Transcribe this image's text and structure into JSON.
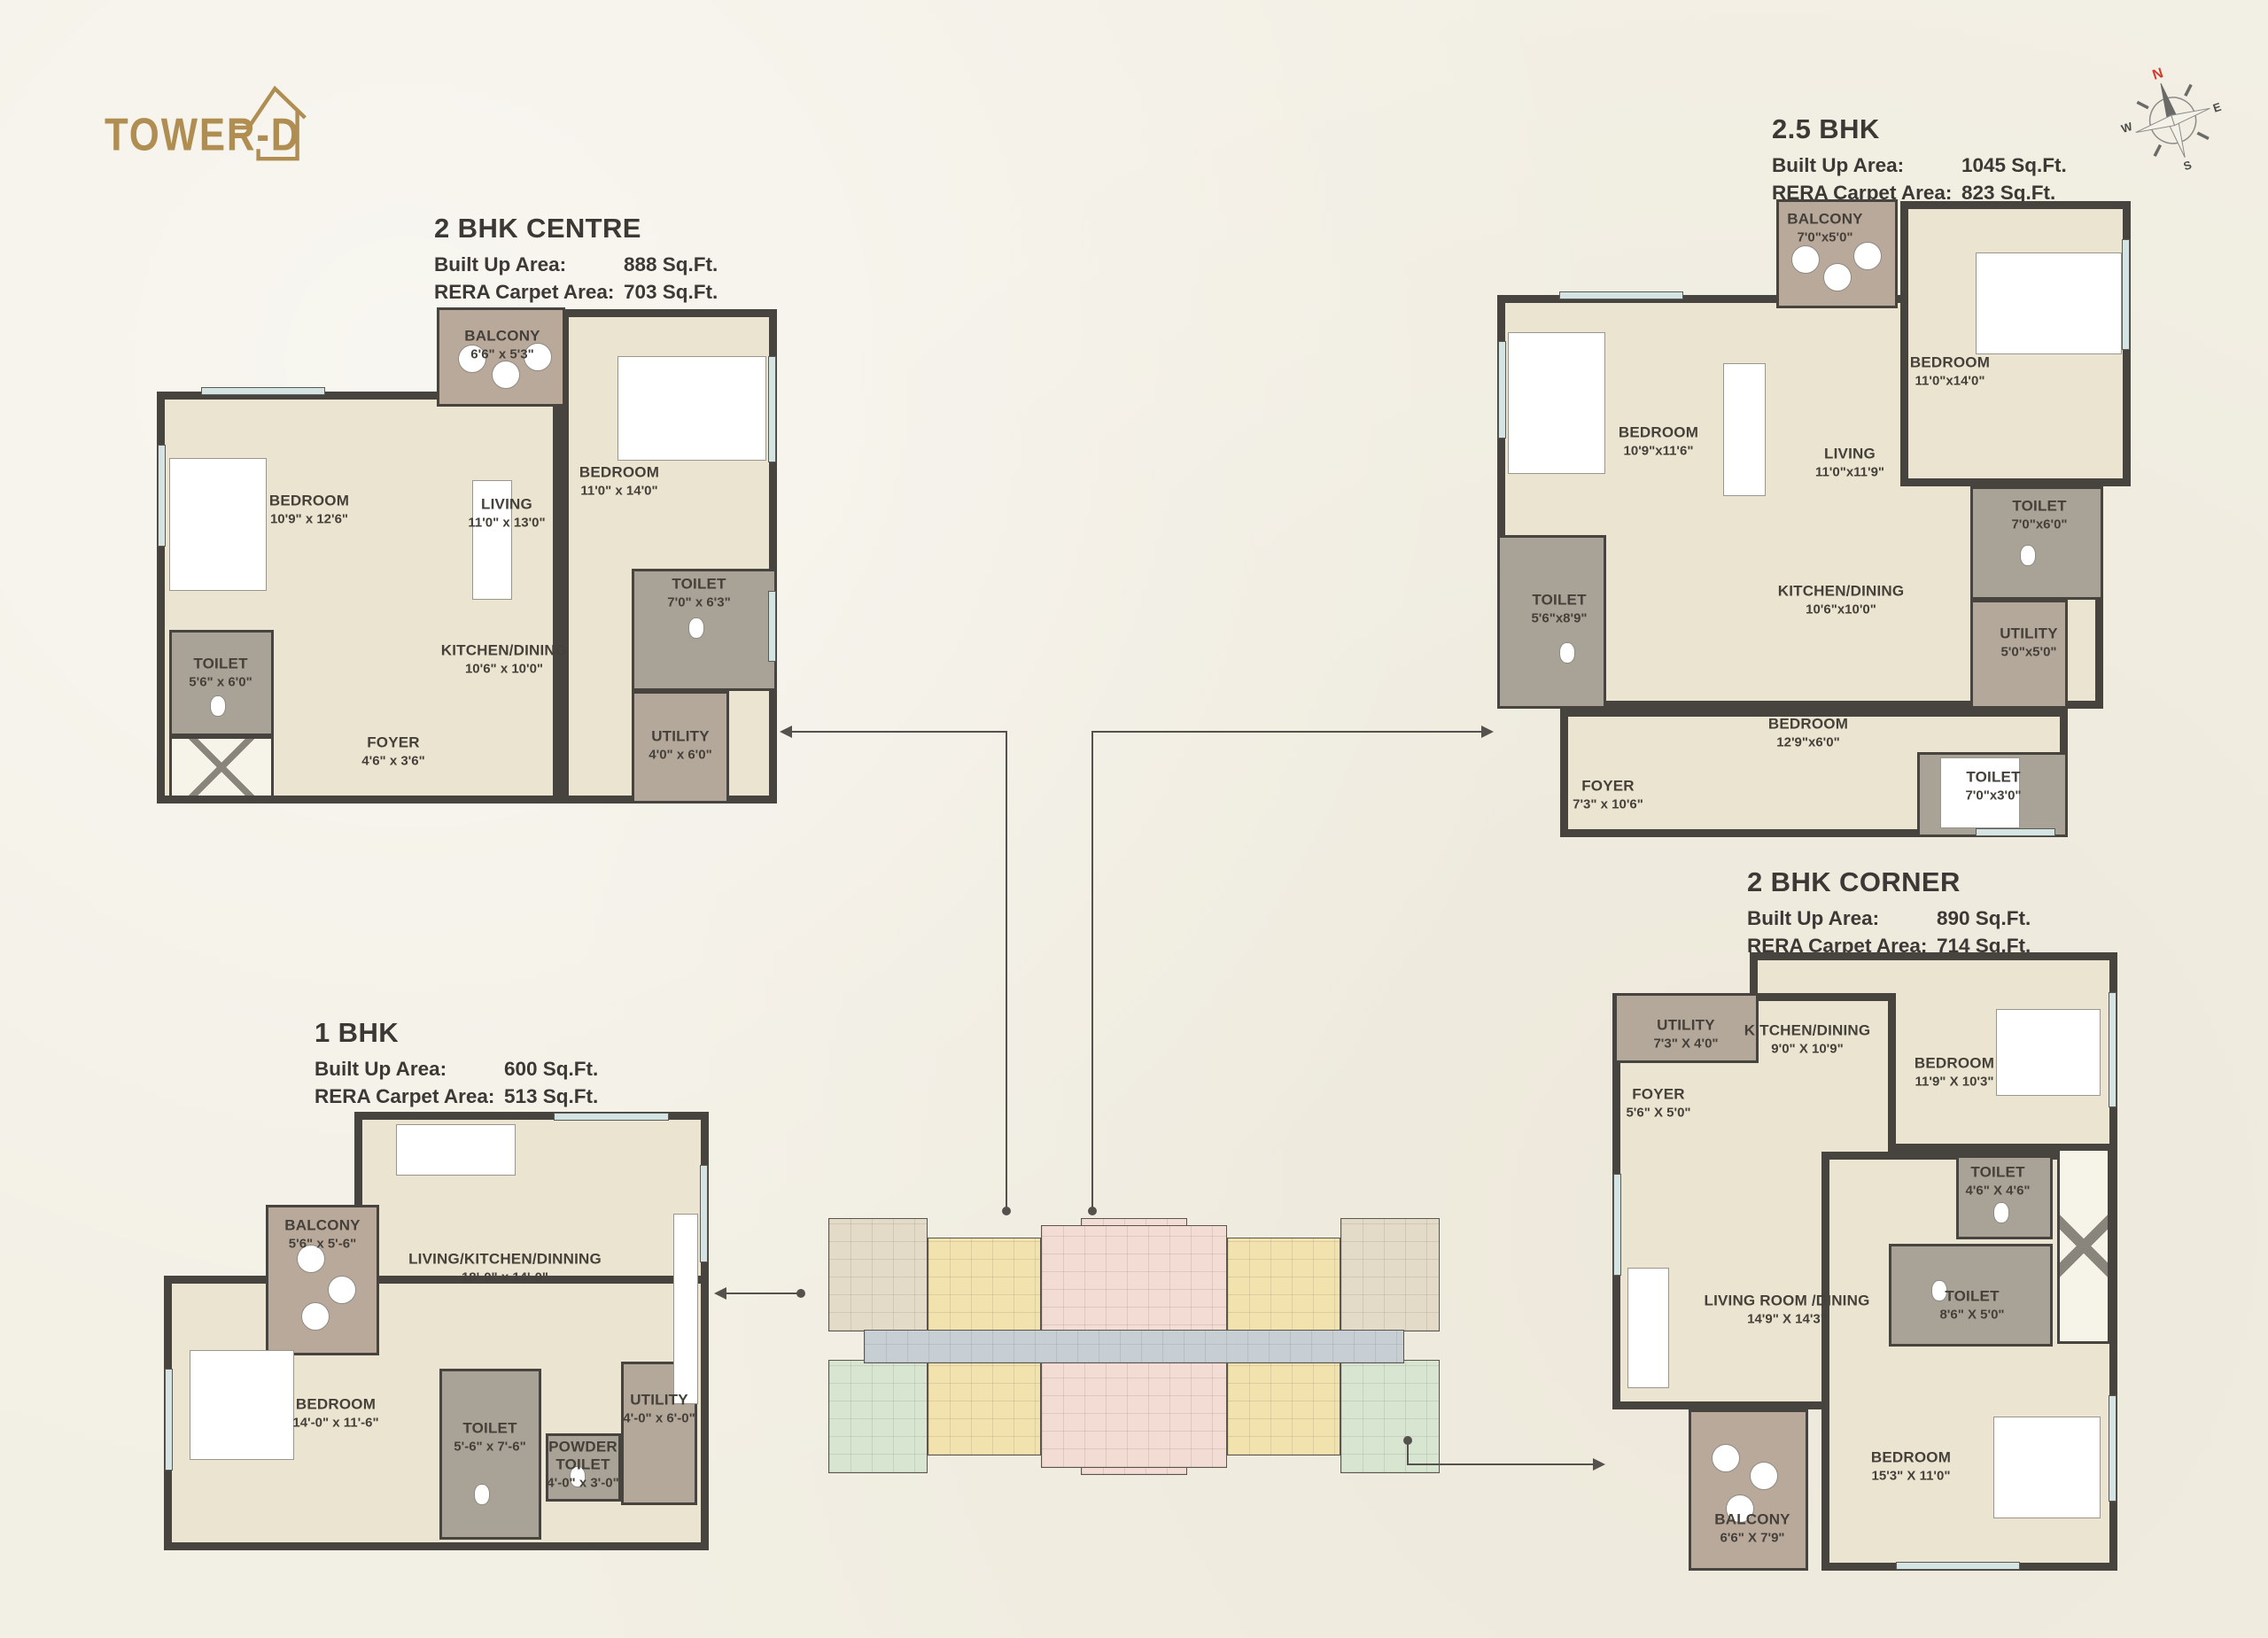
{
  "logo": {
    "text": "TOWER-D"
  },
  "compass": {
    "north": "N",
    "east": "E",
    "south": "S",
    "west": "W"
  },
  "labels": {
    "built_up": "Built Up Area:",
    "rera": "RERA Carpet Area:"
  },
  "units": [
    {
      "id": "2bhk-centre",
      "name": "2 BHK CENTRE",
      "built_up": "888 Sq.Ft.",
      "rera": "703 Sq.Ft.",
      "rooms": [
        {
          "name": "BALCONY",
          "dims": "6'6\" x 5'3\""
        },
        {
          "name": "BEDROOM",
          "dims": "10'9\" x 12'6\""
        },
        {
          "name": "LIVING",
          "dims": "11'0\" x 13'0\""
        },
        {
          "name": "BEDROOM",
          "dims": "11'0\" x 14'0\""
        },
        {
          "name": "TOILET",
          "dims": "7'0\" x 6'3\""
        },
        {
          "name": "TOILET",
          "dims": "5'6\" x 6'0\""
        },
        {
          "name": "KITCHEN/DINING",
          "dims": "10'6\" x 10'0\""
        },
        {
          "name": "FOYER",
          "dims": "4'6\" x 3'6\""
        },
        {
          "name": "UTILITY",
          "dims": "4'0\" x 6'0\""
        }
      ]
    },
    {
      "id": "2-5bhk",
      "name": "2.5 BHK",
      "built_up": "1045 Sq.Ft.",
      "rera": "823 Sq.Ft.",
      "rooms": [
        {
          "name": "BALCONY",
          "dims": "7'0\"x5'0\""
        },
        {
          "name": "BEDROOM",
          "dims": "10'9\"x11'6\""
        },
        {
          "name": "BEDROOM",
          "dims": "11'0\"x14'0\""
        },
        {
          "name": "LIVING",
          "dims": "11'0\"x11'9\""
        },
        {
          "name": "TOILET",
          "dims": "7'0\"x6'0\""
        },
        {
          "name": "TOILET",
          "dims": "5'6\"x8'9\""
        },
        {
          "name": "KITCHEN/DINING",
          "dims": "10'6\"x10'0\""
        },
        {
          "name": "UTILITY",
          "dims": "5'0\"x5'0\""
        },
        {
          "name": "FOYER",
          "dims": "7'3\" x 10'6\""
        },
        {
          "name": "BEDROOM",
          "dims": "12'9\"x6'0\""
        },
        {
          "name": "TOILET",
          "dims": "7'0\"x3'0\""
        }
      ]
    },
    {
      "id": "1bhk",
      "name": "1 BHK",
      "built_up": "600 Sq.Ft.",
      "rera": "513 Sq.Ft.",
      "rooms": [
        {
          "name": "BALCONY",
          "dims": "5'6\" x 5'-6\""
        },
        {
          "name": "LIVING/KITCHEN/DINNING",
          "dims": "18'-0\" x 14'-0\""
        },
        {
          "name": "BEDROOM",
          "dims": "14'-0\" x 11'-6\""
        },
        {
          "name": "TOILET",
          "dims": "5'-6\" x 7'-6\""
        },
        {
          "name": "POWDER TOILET",
          "dims": "4'-0\" x 3'-0\""
        },
        {
          "name": "UTILITY",
          "dims": "4'-0\" x 6'-0\""
        }
      ]
    },
    {
      "id": "2bhk-corner",
      "name": "2 BHK CORNER",
      "built_up": "890 Sq.Ft.",
      "rera": "714 Sq.Ft.",
      "rooms": [
        {
          "name": "UTILITY",
          "dims": "7'3\" X 4'0\""
        },
        {
          "name": "KITCHEN/DINING",
          "dims": "9'0\" X 10'9\""
        },
        {
          "name": "BEDROOM",
          "dims": "11'9\" X 10'3\""
        },
        {
          "name": "FOYER",
          "dims": "5'6\" X 5'0\""
        },
        {
          "name": "TOILET",
          "dims": "4'6\" X 4'6\""
        },
        {
          "name": "TOILET",
          "dims": "8'6\" X 5'0\""
        },
        {
          "name": "LIVING ROOM /DINING",
          "dims": "14'9\" X 14'3\""
        },
        {
          "name": "BEDROOM",
          "dims": "15'3\" X 11'0\""
        },
        {
          "name": "BALCONY",
          "dims": "6'6\" X 7'9\""
        }
      ]
    }
  ],
  "palette": {
    "background": "#f2efe4",
    "logo_gold": "#b08d50",
    "title_text": "#3b3835",
    "wall": "#474440",
    "floor": "#eae4d1",
    "balcony_floor": "#b9a99b",
    "toilet_floor": "#a9a296",
    "utility_floor": "#b4a89a",
    "window_glass": "#d3e4e3",
    "leader_line": "#55524e",
    "keyplan_pink": "#f3dcd3",
    "keyplan_yellow": "#f2e2ae",
    "keyplan_green": "#d8e5d1",
    "keyplan_beige": "#e3dac7",
    "keyplan_corridor": "#c7ced4",
    "compass_north_red": "#d33a30"
  }
}
